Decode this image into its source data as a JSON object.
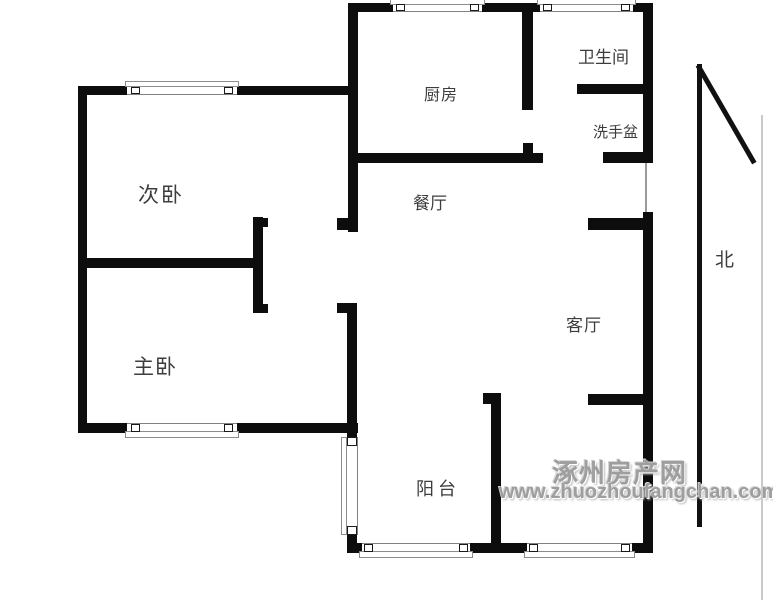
{
  "rooms": {
    "secondary_bedroom": "次卧",
    "kitchen": "厨房",
    "bathroom": "卫生间",
    "washbasin": "洗手盆",
    "dining_room": "餐厅",
    "master_bedroom": "主卧",
    "living_room": "客厅",
    "balcony": "阳台"
  },
  "compass": {
    "north": "北"
  },
  "watermark": {
    "site_name": "涿州房产网",
    "site_url": "www.zhuozhoufangchan.com"
  },
  "colors": {
    "background": "#ffffff",
    "wall": "#0d0d0d",
    "room_label": "#3d3d3d",
    "window_frame": "#828282",
    "watermark": "#9e9e9e"
  }
}
